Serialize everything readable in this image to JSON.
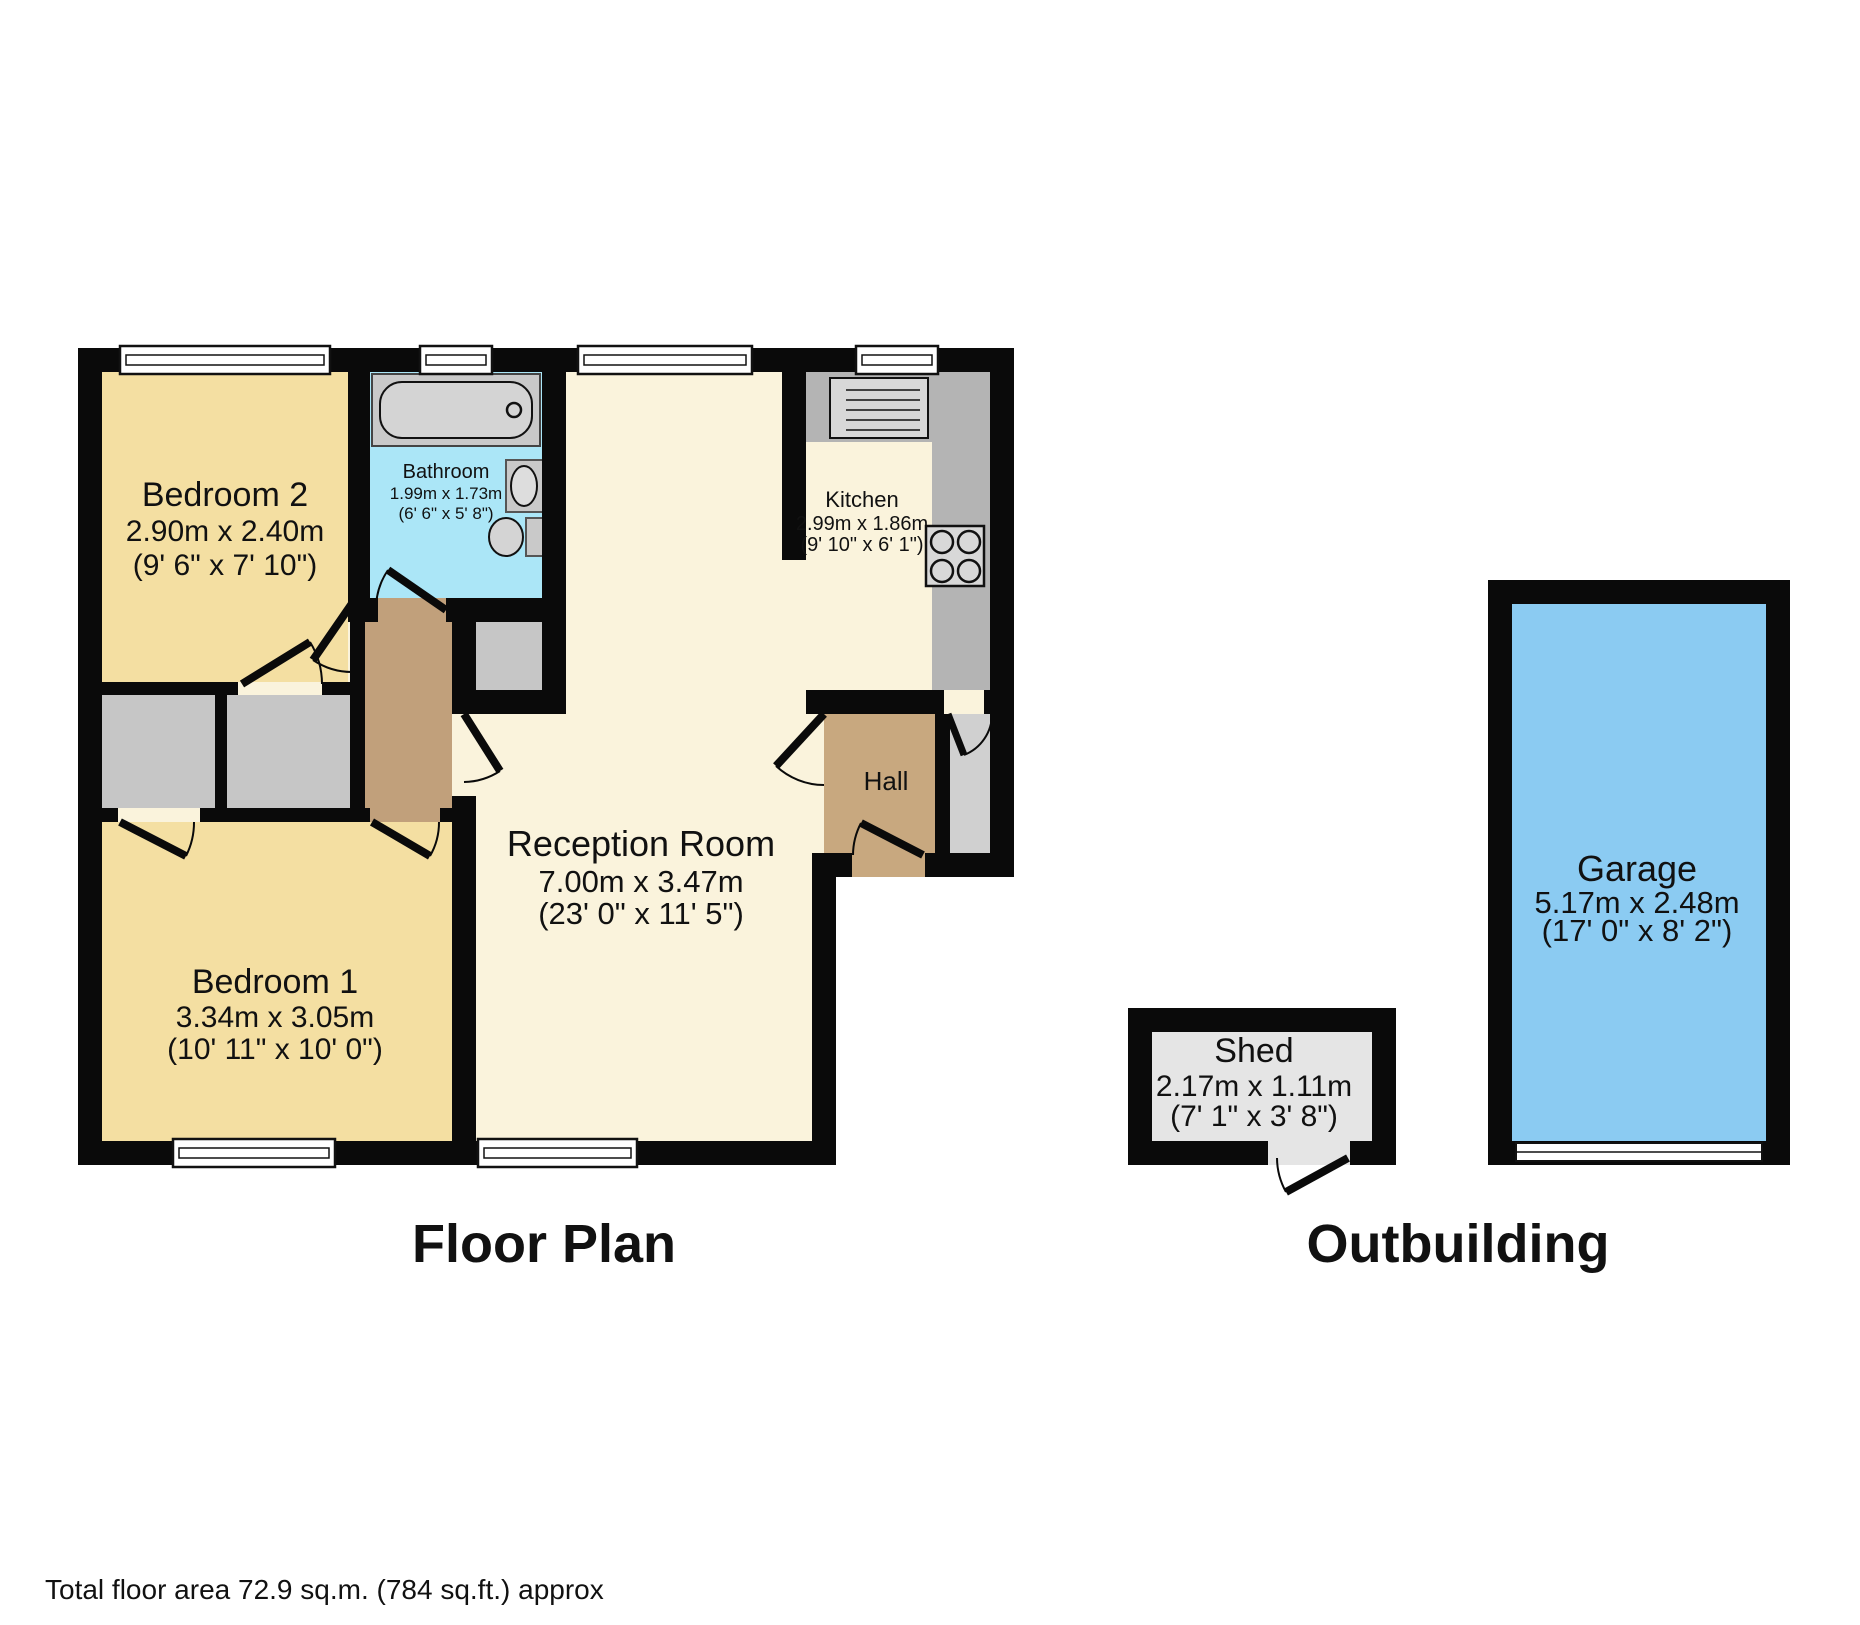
{
  "captions": {
    "floor_plan": "Floor Plan",
    "outbuilding": "Outbuilding"
  },
  "footer": {
    "total_area": "Total floor area 72.9 sq.m. (784 sq.ft.) approx"
  },
  "rooms": {
    "bedroom2": {
      "name": "Bedroom 2",
      "metric": "2.90m x 2.40m",
      "imperial": "(9' 6\" x 7' 10\")"
    },
    "bathroom": {
      "name": "Bathroom",
      "metric": "1.99m x 1.73m",
      "imperial": "(6' 6\" x 5' 8\")"
    },
    "kitchen": {
      "name": "Kitchen",
      "metric": "2.99m x 1.86m",
      "imperial": "(9' 10\" x 6' 1\")"
    },
    "reception": {
      "name": "Reception Room",
      "metric": "7.00m x 3.47m",
      "imperial": "(23' 0\" x 11' 5\")"
    },
    "hall": {
      "name": "Hall"
    },
    "bedroom1": {
      "name": "Bedroom 1",
      "metric": "3.34m x 3.05m",
      "imperial": "(10' 11\" x 10' 0\")"
    },
    "shed": {
      "name": "Shed",
      "metric": "2.17m x 1.11m",
      "imperial": "(7' 1\" x 3' 8\")"
    },
    "garage": {
      "name": "Garage",
      "metric": "5.17m x 2.48m",
      "imperial": "(17' 0\" x 8' 2\")"
    }
  },
  "colors": {
    "wall": "#0a0a0a",
    "bedroom_yellow": "#f4dfa2",
    "living_cream": "#faf3dc",
    "bathroom_blue": "#abe6f7",
    "hall_tan": "#c8a87f",
    "corridor_tan": "#c1a07b",
    "closet_gray": "#c6c6c6",
    "counter_gray": "#b4b4b4",
    "fixture_gray": "#d8d8d8",
    "porch_gray": "#d0d0d0",
    "shed_gray": "#e5e5e5",
    "garage_blue": "#8bcbf2"
  }
}
